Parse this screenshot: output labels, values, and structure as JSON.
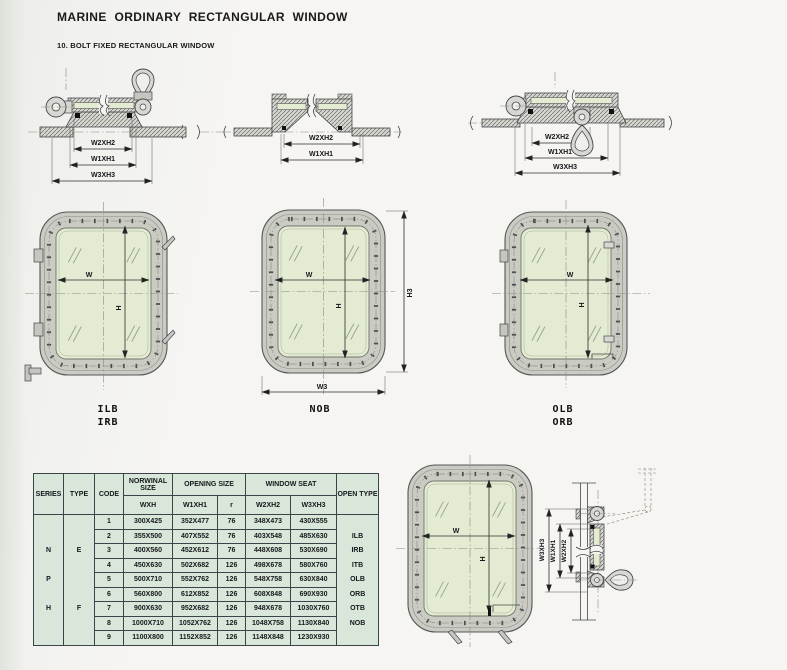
{
  "page": {
    "title": "MARINE ORDINARY RECTANGULAR WINDOW",
    "subtitle": "10. BOLT FIXED RECTANGULAR WINDOW"
  },
  "colors": {
    "frame": "#caccc4",
    "glass": "#e3ecd2",
    "table_bg": "#d9e7db",
    "table_line": "#3a444a",
    "page_bg": "#f5f4f1"
  },
  "sections": {
    "top_left": {
      "dim1": "W2XH2",
      "dim2": "W1XH1",
      "dim3": "W3XH3"
    },
    "top_middle": {
      "dim1": "W2XH2",
      "dim2": "W1XH1"
    },
    "top_right": {
      "dim1": "W2XH2",
      "dim2": "W1XH1",
      "dim3": "W3XH3"
    },
    "side": {
      "dim1": "W3XH3",
      "dim2": "W1XH1",
      "dim3": "W2XH2"
    }
  },
  "windows": {
    "left": {
      "w": "W",
      "h": "H",
      "labels": [
        "ILB",
        "IRB"
      ]
    },
    "middle": {
      "w": "W",
      "h": "H",
      "h3": "H3",
      "w3": "W3",
      "labels": [
        "NOB"
      ]
    },
    "right": {
      "w": "W",
      "h": "H",
      "labels": [
        "OLB",
        "ORB"
      ]
    },
    "bottom": {
      "w": "W",
      "h": "H"
    }
  },
  "table": {
    "headers": {
      "series": "SERIES",
      "type": "TYPE",
      "code": "CODE",
      "nominal": "NORWINAL SIZE",
      "nominal_sub": "WXH",
      "opening": "OPENING SIZE",
      "opening_sub1": "W1XH1",
      "opening_sub2": "r",
      "seat": "WINDOW SEAT",
      "seat_sub1": "W2XH2",
      "seat_sub2": "W3XH3",
      "open_type": "OPEN TYPE"
    },
    "series": [
      "N",
      "P",
      "H"
    ],
    "types": [
      "E",
      "F"
    ],
    "open_types": [
      "ILB",
      "IRB",
      "ITB",
      "OLB",
      "ORB",
      "OTB",
      "NOB"
    ],
    "rows": [
      {
        "code": "1",
        "wxh": "300X425",
        "w1xh1": "352X477",
        "r": "76",
        "w2xh2": "348X473",
        "w3xh3": "430X555"
      },
      {
        "code": "2",
        "wxh": "355X500",
        "w1xh1": "407X552",
        "r": "76",
        "w2xh2": "403X548",
        "w3xh3": "485X630"
      },
      {
        "code": "3",
        "wxh": "400X560",
        "w1xh1": "452X612",
        "r": "76",
        "w2xh2": "448X608",
        "w3xh3": "530X690"
      },
      {
        "code": "4",
        "wxh": "450X630",
        "w1xh1": "502X682",
        "r": "126",
        "w2xh2": "498X678",
        "w3xh3": "580X760"
      },
      {
        "code": "5",
        "wxh": "500X710",
        "w1xh1": "552X762",
        "r": "126",
        "w2xh2": "548X758",
        "w3xh3": "630X840"
      },
      {
        "code": "6",
        "wxh": "560X800",
        "w1xh1": "612X852",
        "r": "126",
        "w2xh2": "608X848",
        "w3xh3": "690X930"
      },
      {
        "code": "7",
        "wxh": "900X630",
        "w1xh1": "952X682",
        "r": "126",
        "w2xh2": "948X678",
        "w3xh3": "1030X760"
      },
      {
        "code": "8",
        "wxh": "1000X710",
        "w1xh1": "1052X762",
        "r": "126",
        "w2xh2": "1048X758",
        "w3xh3": "1130X840"
      },
      {
        "code": "9",
        "wxh": "1100X800",
        "w1xh1": "1152X852",
        "r": "126",
        "w2xh2": "1148X848",
        "w3xh3": "1230X930"
      }
    ]
  }
}
